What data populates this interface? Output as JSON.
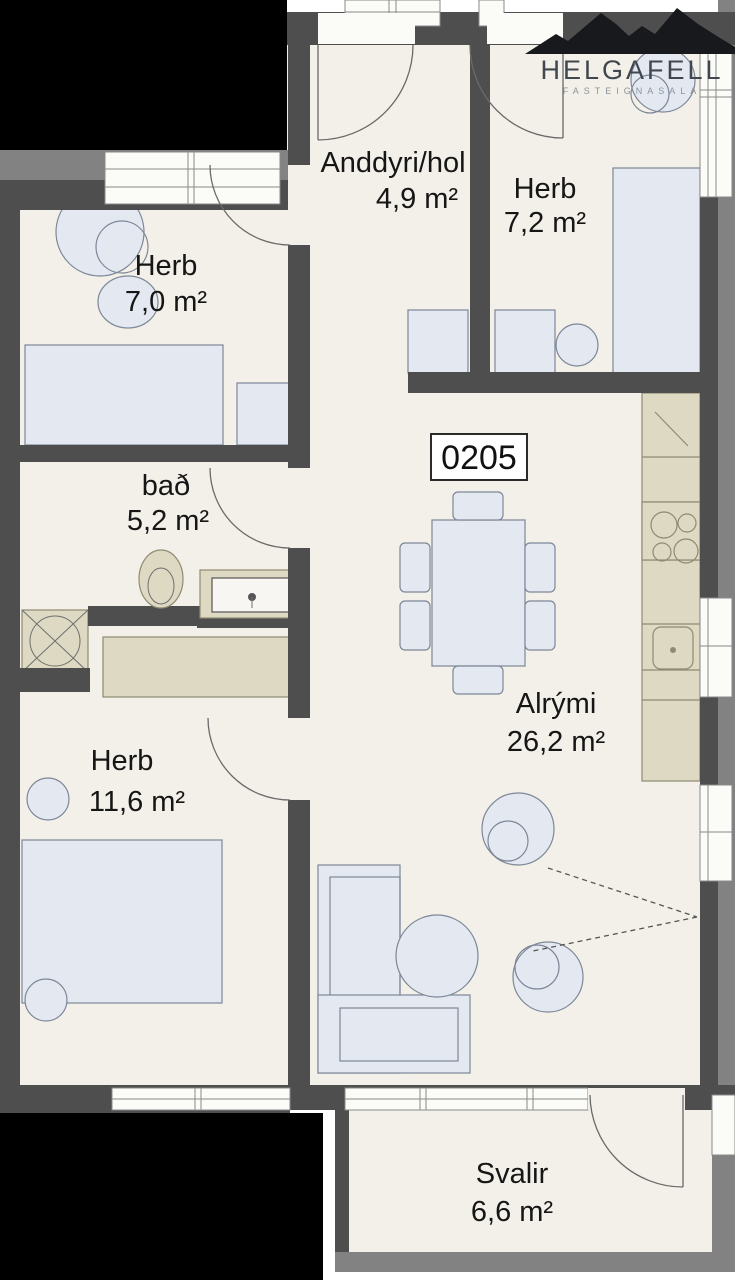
{
  "logo": {
    "name": "HELGAFELL",
    "tagline": "FASTEIGNASALA"
  },
  "unit": {
    "number": "0205"
  },
  "rooms": {
    "anddyri": {
      "label": "Anddyri/hol",
      "area": "4,9 m²"
    },
    "herb_7_2": {
      "label": "Herb",
      "area": "7,2 m²"
    },
    "herb_7_0": {
      "label": "Herb",
      "area": "7,0 m²"
    },
    "bad": {
      "label": "bað",
      "area": "5,2 m²"
    },
    "alrymi": {
      "label": "Alrými",
      "area": "26,2 m²"
    },
    "herb_11_6": {
      "label": "Herb",
      "area": "11,6 m²"
    },
    "svalir": {
      "label": "Svalir",
      "area": "6,6 m²"
    }
  },
  "colors": {
    "floor": "#f2f0e8",
    "wall": "#4e4e4e",
    "wall_outer": "#828282",
    "furniture": "#e4e9f1",
    "counter": "#ddd9c2",
    "outside": "#000000",
    "logo_text": "#40474e"
  }
}
